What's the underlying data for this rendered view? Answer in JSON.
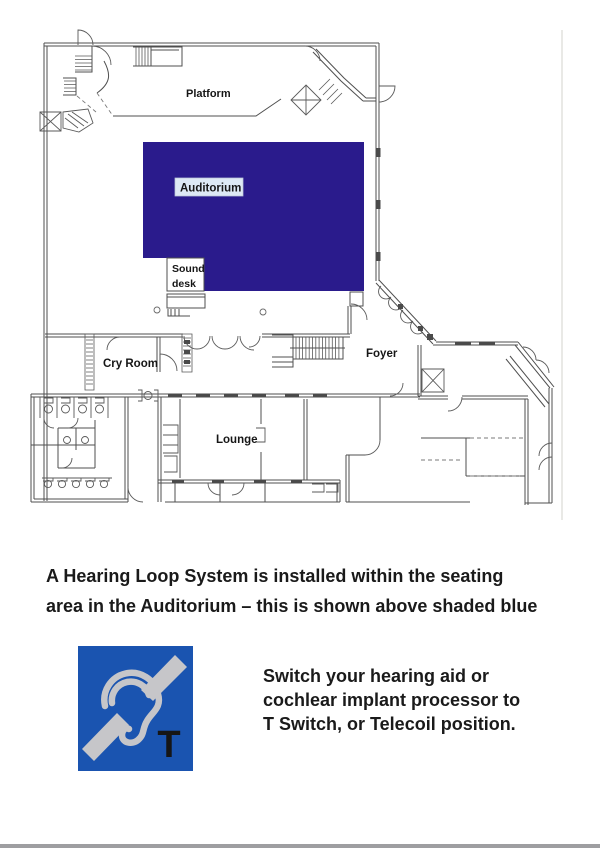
{
  "floorplan": {
    "labels": {
      "platform": "Platform",
      "auditorium": "Auditorium",
      "sound_line1": "Sound",
      "sound_line2": "desk",
      "cry_room": "Cry Room",
      "foyer": "Foyer",
      "lounge": "Lounge"
    },
    "auditorium_shade_color": "#2a1b8c",
    "auditorium_label_bg": "#dde9f5",
    "line_color": "#4f4f4f"
  },
  "caption": {
    "line1": "A Hearing Loop System is installed within the seating",
    "line2": "area in the Auditorium – this is shown above shaded blue"
  },
  "hearing_loop": {
    "icon": {
      "name": "hearing-loop-T-icon",
      "letter": "T",
      "bg_color": "#1a54b0",
      "symbol_color": "#c6c6c9"
    },
    "text_line1": "Switch your hearing aid or",
    "text_line2": "cochlear implant processor to",
    "text_line3": "T Switch, or Telecoil position."
  }
}
